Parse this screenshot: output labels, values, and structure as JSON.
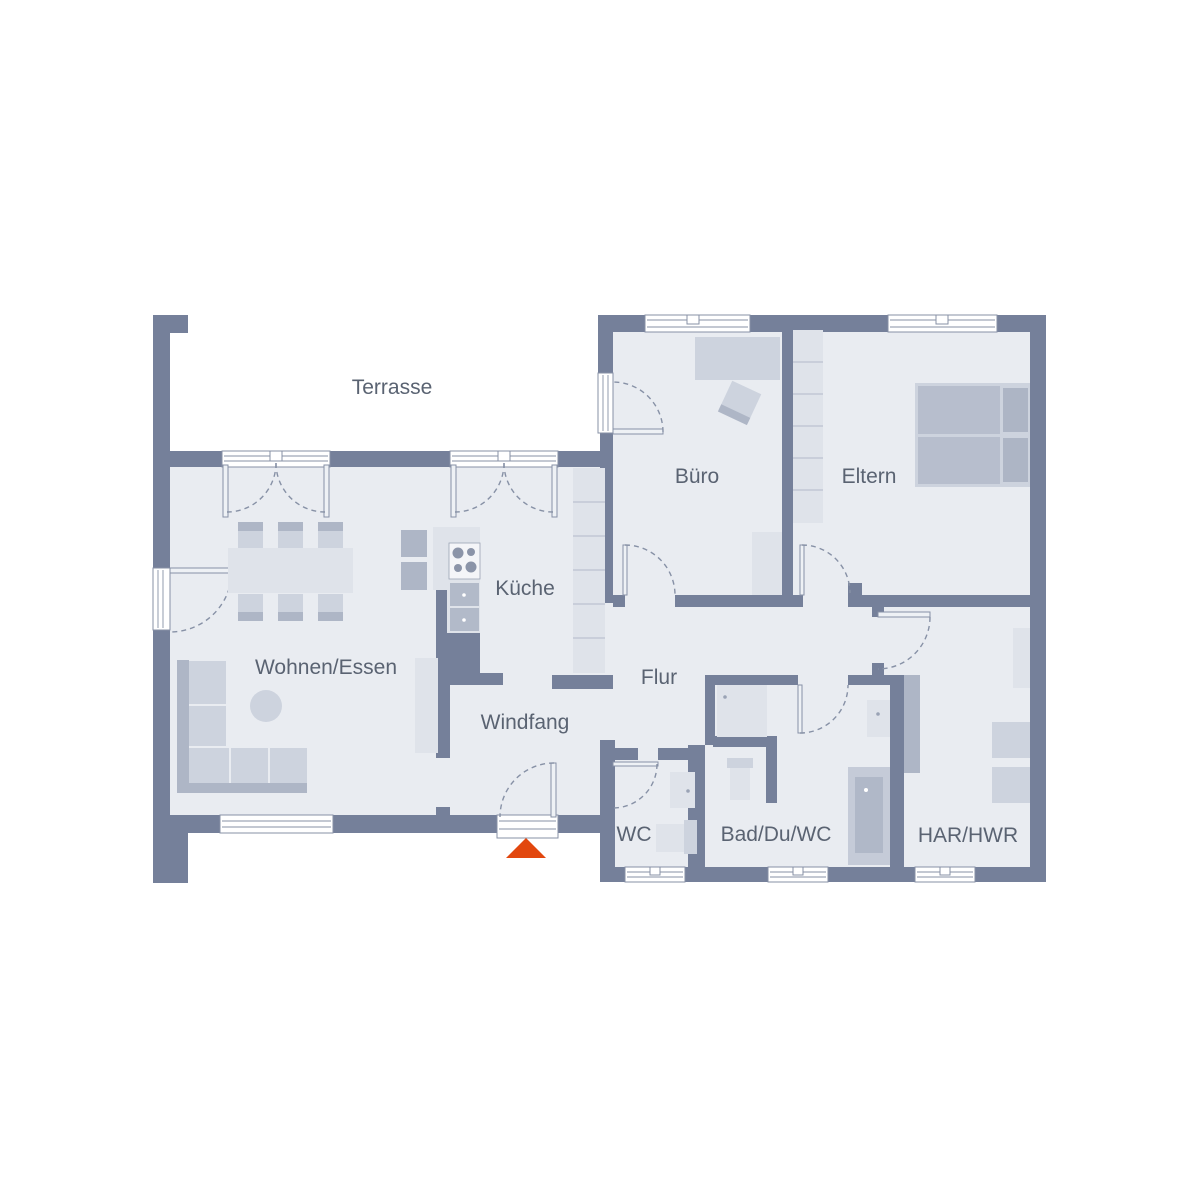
{
  "title": "Grundriss Erdgeschoss Bungalow",
  "colors": {
    "wall": "#75809a",
    "floor": "#e9ecf1",
    "furn-light": "#dfe3ea",
    "furn-mid": "#cdd3de",
    "furn-dark": "#aeb6c6",
    "bed": "#b7becd",
    "line": "#8791a6",
    "div": "#c2c8d4",
    "text": "#5a6372",
    "accent": "#e2470e"
  },
  "rooms": [
    {
      "id": "terrasse",
      "label": "Terrasse"
    },
    {
      "id": "wohnen-essen",
      "label": "Wohnen/Essen"
    },
    {
      "id": "kueche",
      "label": "Küche"
    },
    {
      "id": "windfang",
      "label": "Windfang"
    },
    {
      "id": "flur",
      "label": "Flur"
    },
    {
      "id": "buero",
      "label": "Büro"
    },
    {
      "id": "eltern",
      "label": "Eltern"
    },
    {
      "id": "wc",
      "label": "WC"
    },
    {
      "id": "bad",
      "label": "Bad/Du/WC"
    },
    {
      "id": "har-hwr",
      "label": "HAR/HWR"
    }
  ],
  "entrance_marker": {
    "name": "entrance-arrow",
    "shape": "triangle",
    "color": "#e2470e"
  }
}
